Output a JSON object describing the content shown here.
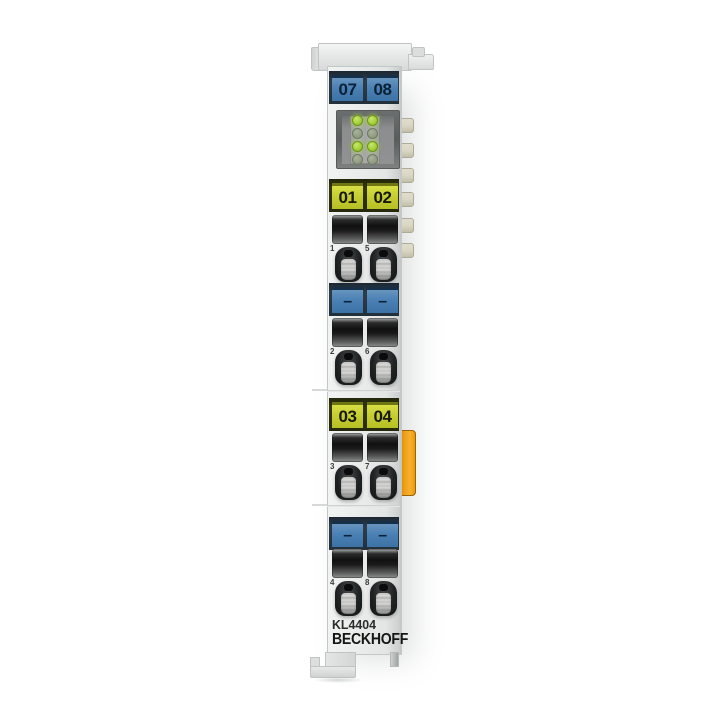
{
  "product": {
    "model": "KL4404",
    "brand": "BECKHOFF"
  },
  "labels": {
    "top_blue": [
      "07",
      "08"
    ],
    "yellow_upper": [
      "01",
      "02"
    ],
    "minus_upper": [
      "–",
      "–"
    ],
    "yellow_lower": [
      "03",
      "04"
    ],
    "minus_lower": [
      "–",
      "–"
    ]
  },
  "terminal_rows": [
    {
      "numbers": [
        "1",
        "5"
      ]
    },
    {
      "numbers": [
        "2",
        "6"
      ]
    },
    {
      "numbers": [
        "3",
        "7"
      ]
    },
    {
      "numbers": [
        "4",
        "8"
      ]
    }
  ],
  "leds": {
    "grid": [
      [
        "on",
        "on"
      ],
      [
        "off",
        "off"
      ],
      [
        "on",
        "on"
      ],
      [
        "off",
        "off"
      ]
    ]
  },
  "colors": {
    "label_blue": "#4a80b4",
    "label_blue_text": "#0b2136",
    "label_yellow": "#c6ce31",
    "label_yellow_text": "#15180a",
    "strip_dark_blue": "#2e3d49",
    "strip_dark_olive": "#34370f",
    "led_on": "#9fcb33",
    "led_off": "#8e9a80",
    "latch_orange": "#f09d12",
    "tab_beige": "#d9d6c3"
  }
}
